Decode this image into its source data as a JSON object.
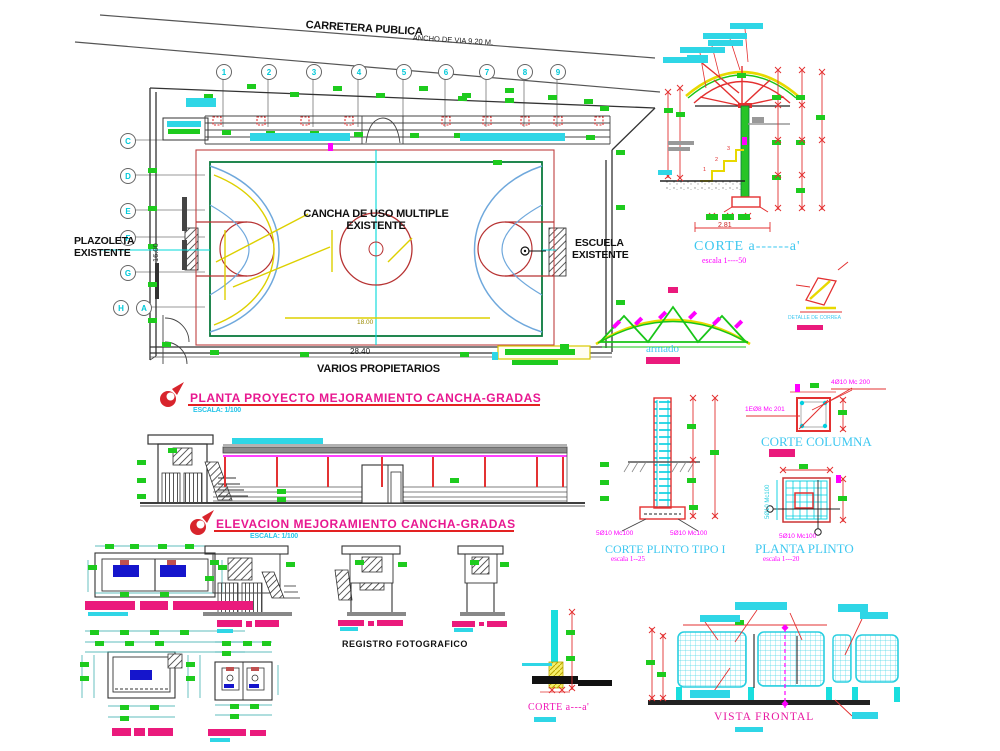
{
  "site_plan": {
    "road_label": "CARRETERA PUBLICA",
    "road_width_label": "ANCHO DE VIA 9.20 M.",
    "grid_cols": [
      "1",
      "2",
      "3",
      "4",
      "5",
      "6",
      "7",
      "8",
      "9"
    ],
    "grid_rows": [
      "C",
      "D",
      "E",
      "F",
      "G",
      "H",
      "A"
    ],
    "left_label1": "PLAZOLETA",
    "left_label2": "EXISTENTE",
    "right_label1": "ESCUELA",
    "right_label2": "EXISTENTE",
    "court_label1": "CANCHA DE USO MULTIPLE",
    "court_label2": "EXISTENTE",
    "bottom_label": "VARIOS PROPIETARIOS",
    "dim_width": "28.40",
    "dim_height": "16.00",
    "dim_inner": "18.00"
  },
  "titles": {
    "plan": {
      "text": "PLANTA PROYECTO MEJORAMIENTO CANCHA-GRADAS",
      "scale": "ESCALA: 1/100"
    },
    "elevation": {
      "text": "ELEVACION MEJORAMIENTO CANCHA-GRADAS",
      "scale": "ESCALA: 1/100"
    }
  },
  "section_a": {
    "title": "CORTE a------a'",
    "scale": "escala  1----50",
    "dim": "2.81",
    "step1": "1",
    "step2": "2",
    "step3": "3"
  },
  "truss": {
    "label": "armado"
  },
  "correa": {
    "label": "DETALLE DE CORREA"
  },
  "plinto_corte": {
    "title": "CORTE  PLINTO TIPO I",
    "scale": "escala  1--25",
    "rebar_left": "5Ø10 Mc100",
    "rebar_right": "5Ø10 Mc100"
  },
  "columna": {
    "title": "CORTE COLUMNA",
    "rebar_top": "4Ø10 Mc 200",
    "rebar_side": "1EØ8 Mc 201"
  },
  "plinto_planta": {
    "title": "PLANTA PLINTO",
    "scale": "escala  1---20",
    "rebar_left": "5Ø10 Mc100",
    "rebar_bottom": "5Ø10 Mc100"
  },
  "photos": {
    "label": "REGISTRO FOTOGRAFICO"
  },
  "corte_bottom": {
    "title": "CORTE a---a'"
  },
  "vista_frontal": {
    "title": "VISTA FRONTAL"
  },
  "colors": {
    "cyan": "#00e0e0",
    "title_cyan": "#3fc8f0",
    "magenta": "#ff00ff",
    "pink_bar": "#ea1a7c",
    "green": "#1ecb1e",
    "dark_green": "#0a7a3c",
    "red": "#e03030",
    "yellow": "#e8d800",
    "blue": "#6fa8dc"
  }
}
